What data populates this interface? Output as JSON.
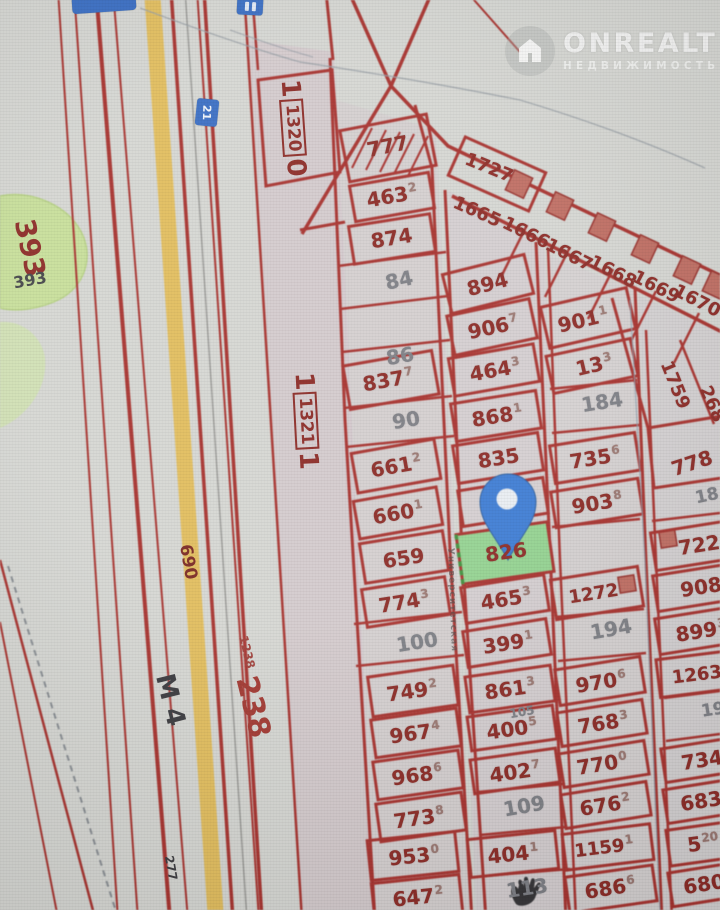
{
  "watermark": {
    "brand": "ONREALT",
    "subtitle": "НЕДВИЖИМОСТЬ"
  },
  "road": {
    "highway": "М 4",
    "km_main": "238",
    "km_small": "1238",
    "marker_a": "690",
    "marker_b": "277",
    "route_sign": "21"
  },
  "areas": {
    "green_big": "393",
    "green_small": "393"
  },
  "quarters": {
    "q1": "1320",
    "q1_prefix": "1",
    "q1_suffix": "0",
    "q2": "1321",
    "q2_prefix": "1",
    "q2_suffix": "1"
  },
  "street": {
    "name": "Университетская"
  },
  "selection": {
    "plot": "826",
    "fill": "#95d392",
    "pin_color": "#3f7dd4"
  },
  "plots": [
    {
      "n": "777"
    },
    {
      "n": "463",
      "s": "2"
    },
    {
      "n": "874"
    },
    {
      "n": "837",
      "s": "7"
    },
    {
      "n": "661",
      "s": "2"
    },
    {
      "n": "660",
      "s": "1"
    },
    {
      "n": "659"
    },
    {
      "n": "774",
      "s": "3"
    },
    {
      "n": "749",
      "s": "2"
    },
    {
      "n": "967",
      "s": "4"
    },
    {
      "n": "968",
      "s": "6"
    },
    {
      "n": "773",
      "s": "8"
    },
    {
      "n": "953",
      "s": "0"
    },
    {
      "n": "647",
      "s": "2"
    },
    {
      "n": "894"
    },
    {
      "n": "906",
      "s": "7"
    },
    {
      "n": "464",
      "s": "3"
    },
    {
      "n": "868",
      "s": "1"
    },
    {
      "n": "835"
    },
    {
      "n": "465",
      "s": "3"
    },
    {
      "n": "399",
      "s": "1"
    },
    {
      "n": "861",
      "s": "3"
    },
    {
      "n": "400",
      "s": "5"
    },
    {
      "n": "402",
      "s": "7"
    },
    {
      "n": "404",
      "s": "1"
    },
    {
      "n": "901",
      "s": "1"
    },
    {
      "n": "13",
      "s": "3"
    },
    {
      "n": "735",
      "s": "6"
    },
    {
      "n": "903",
      "s": "8"
    },
    {
      "n": "1272"
    },
    {
      "n": "970",
      "s": "6"
    },
    {
      "n": "768",
      "s": "3"
    },
    {
      "n": "770",
      "s": "0"
    },
    {
      "n": "676",
      "s": "2"
    },
    {
      "n": "1159",
      "s": "1"
    },
    {
      "n": "686",
      "s": "6"
    },
    {
      "n": "1727"
    },
    {
      "n": "1665"
    },
    {
      "n": "1666"
    },
    {
      "n": "1667"
    },
    {
      "n": "1668"
    },
    {
      "n": "1669"
    },
    {
      "n": "1670"
    },
    {
      "n": "1759"
    },
    {
      "n": "268"
    },
    {
      "n": "778"
    },
    {
      "n": "722"
    },
    {
      "n": "908"
    },
    {
      "n": "899",
      "s": "3"
    },
    {
      "n": "1263"
    },
    {
      "n": "734"
    },
    {
      "n": "683"
    },
    {
      "n": "5",
      "s": "20"
    },
    {
      "n": "680"
    }
  ],
  "vacant": [
    "84",
    "86",
    "90",
    "100",
    "184",
    "194",
    "105",
    "109",
    "113",
    "18",
    "19"
  ]
}
